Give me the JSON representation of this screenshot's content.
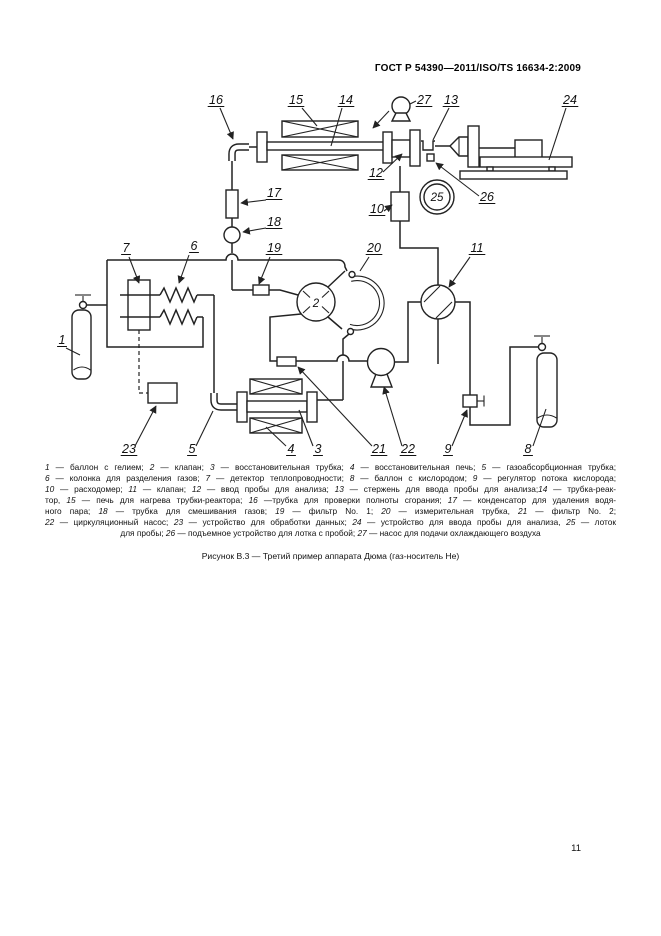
{
  "page": {
    "header": "ГОСТ Р 54390—2011/ISO/TS 16634-2:2009",
    "caption": "Рисунок В.3 — Третий пример аппарата Дюма (газ-носитель He)",
    "page_number": "11"
  },
  "diagram": {
    "labels": [
      "1",
      "5",
      "23",
      "4",
      "3",
      "21",
      "22",
      "9",
      "8",
      "16",
      "15",
      "14",
      "27",
      "13",
      "24",
      "12",
      "26",
      "10",
      "17",
      "18",
      "11",
      "20",
      "19",
      "7",
      "6",
      "2",
      "25"
    ]
  },
  "legend": {
    "lines": [
      {
        "align": "justify",
        "segments": [
          [
            "1",
            " — баллон с гелием; "
          ],
          [
            "2",
            " — клапан; "
          ],
          [
            "3",
            " — восстановительная трубка; "
          ],
          [
            "4",
            " — восстановительная печь; "
          ],
          [
            "5",
            " — газоабсорбционная трубка;"
          ]
        ]
      },
      {
        "align": "justify",
        "segments": [
          [
            "6",
            " — колонка для разделения газов; "
          ],
          [
            "7",
            " — детектор теплопроводности; "
          ],
          [
            "8",
            " — баллон с кислородом; "
          ],
          [
            "9",
            " — регулятор потока кислорода;"
          ]
        ]
      },
      {
        "align": "justify",
        "segments": [
          [
            "10",
            " — расходомер; "
          ],
          [
            "11",
            " — клапан; "
          ],
          [
            "12",
            " — ввод пробы для анализа; "
          ],
          [
            "13",
            " — стержень для ввода пробы для анализа;"
          ],
          [
            "14",
            " — трубка-реак-"
          ]
        ]
      },
      {
        "align": "justify",
        "segments": [
          [
            "",
            "тор, "
          ],
          [
            "15",
            " — печь для нагрева трубки-реактора; "
          ],
          [
            "16",
            " —трубка для проверки полноты сгорания; "
          ],
          [
            "17",
            " — конденсатор для удаления водя-"
          ]
        ]
      },
      {
        "align": "justify",
        "segments": [
          [
            "",
            "ного пара; "
          ],
          [
            "18",
            " — трубка для смешивания газов; "
          ],
          [
            "19",
            " — фильтр No. 1; "
          ],
          [
            "20",
            " — измерительная трубка, "
          ],
          [
            "21",
            " — фильтр No. 2;"
          ]
        ]
      },
      {
        "align": "justify",
        "segments": [
          [
            "22",
            " — циркуляционный насос; "
          ],
          [
            "23",
            " — устройство для обработки данных; "
          ],
          [
            "24",
            " — устройство для ввода пробы для анализа, "
          ],
          [
            "25",
            " — лоток"
          ]
        ]
      },
      {
        "align": "center",
        "segments": [
          [
            "",
            "для пробы; "
          ],
          [
            "26",
            " — подъемное устройство для лотка с пробой; "
          ],
          [
            "27",
            " — насос для подачи охлаждающего воздуха"
          ]
        ]
      }
    ]
  }
}
